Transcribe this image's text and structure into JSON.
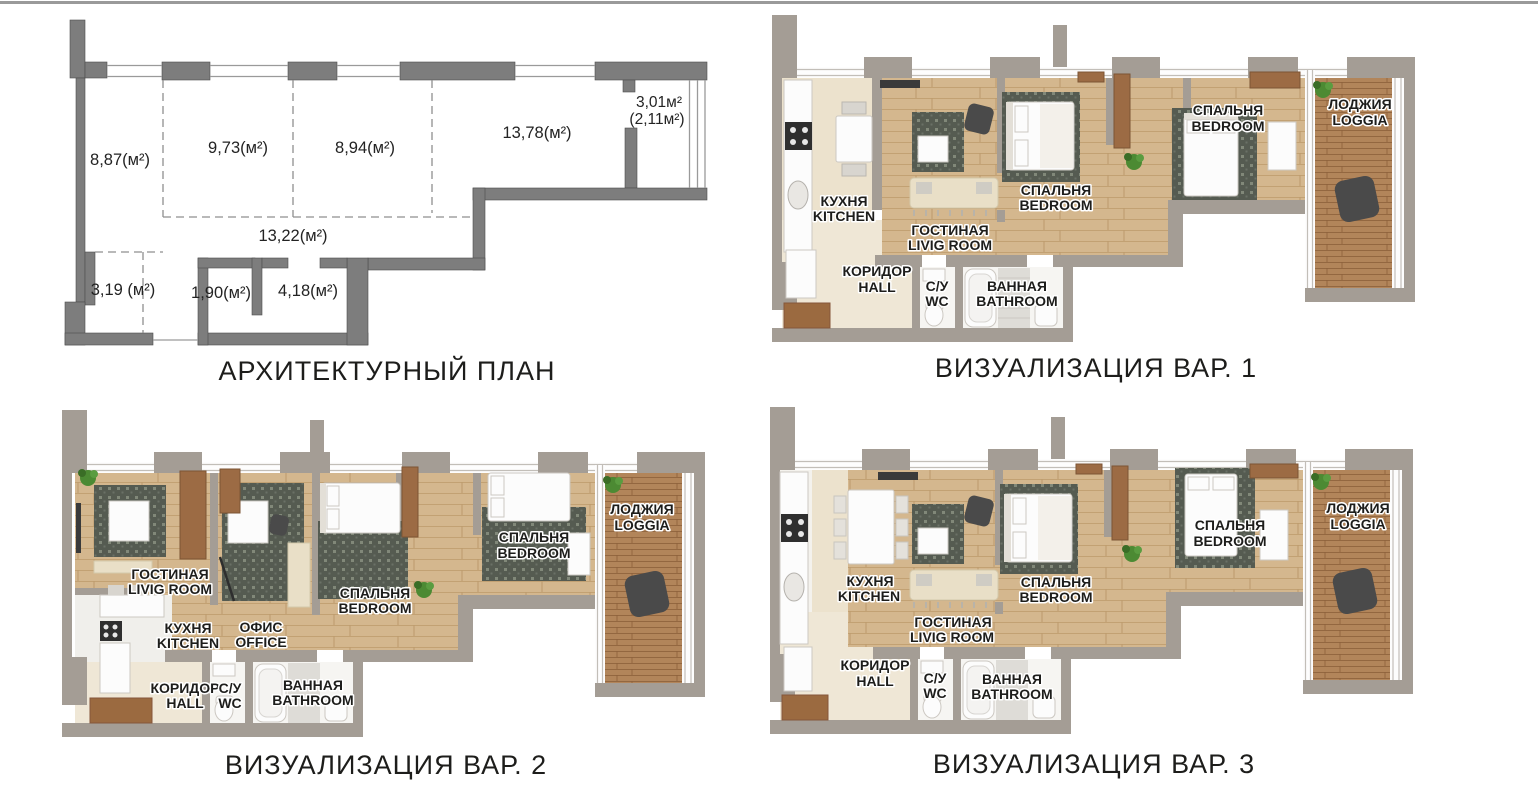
{
  "page": {
    "background": "#ffffff",
    "top_rule_color": "#9a9a9a"
  },
  "palette": {
    "plan_wall": "#7d7d7d",
    "viz_wall": "#a49d95",
    "wood_floor": "#d4b78e",
    "loggia_wood": "#b2855a",
    "kitchen_tile": "#ece2cd",
    "bath_tile": "#f6f5f2",
    "rug_dark": "#555b51",
    "furniture_brown": "#9c6b44",
    "plant_green": "#4c8a33",
    "label_text": "#1d1d1b"
  },
  "plan": {
    "caption": "АРХИТЕКТУРНЫЙ ПЛАН",
    "areas": {
      "room1": "8,87(м²)",
      "room2": "9,73(м²)",
      "room3": "8,94(м²)",
      "room4": "13,78(м²)",
      "balcony1": "3,01м²",
      "balcony2": "(2,11м²)",
      "corridor": "13,22(м²)",
      "room5": "3,19 (м²)",
      "wc": "1,90(м²)",
      "bath": "4,18(м²)"
    }
  },
  "viz1": {
    "caption": "ВИЗУАЛИЗАЦИЯ ВАР. 1",
    "rooms": {
      "kitchen_ru": "КУХНЯ",
      "kitchen_en": "KITCHEN",
      "living_ru": "ГОСТИНАЯ",
      "living_en": "LIVIG ROOM",
      "bedroom1_ru": "СПАЛЬНЯ",
      "bedroom1_en": "BEDROOM",
      "bedroom2_ru": "СПАЛЬНЯ",
      "bedroom2_en": "BEDROOM",
      "loggia_ru": "ЛОДЖИЯ",
      "loggia_en": "LOGGIA",
      "hall_ru": "КОРИДОР",
      "hall_en": "HALL",
      "wc_ru": "С/У",
      "wc_en": "WC",
      "bath_ru": "ВАННАЯ",
      "bath_en": "BATHROOM"
    }
  },
  "viz2": {
    "caption": "ВИЗУАЛИЗАЦИЯ ВАР. 2",
    "rooms": {
      "living_ru": "ГОСТИНАЯ",
      "living_en": "LIVIG ROOM",
      "kitchen_ru": "КУХНЯ",
      "kitchen_en": "KITCHEN",
      "office_ru": "ОФИС",
      "office_en": "OFFICE",
      "bedroom1_ru": "СПАЛЬНЯ",
      "bedroom1_en": "BEDROOM",
      "bedroom2_ru": "СПАЛЬНЯ",
      "bedroom2_en": "BEDROOM",
      "loggia_ru": "ЛОДЖИЯ",
      "loggia_en": "LOGGIA",
      "hall_ru": "КОРИДОР",
      "hall_en": "HALL",
      "wc_ru": "С/У",
      "wc_en": "WC",
      "bath_ru": "ВАННАЯ",
      "bath_en": "BATHROOM"
    }
  },
  "viz3": {
    "caption": "ВИЗУАЛИЗАЦИЯ ВАР. 3",
    "rooms": {
      "kitchen_ru": "КУХНЯ",
      "kitchen_en": "KITCHEN",
      "living_ru": "ГОСТИНАЯ",
      "living_en": "LIVIG ROOM",
      "bedroom1_ru": "СПАЛЬНЯ",
      "bedroom1_en": "BEDROOM",
      "bedroom2_ru": "СПАЛЬНЯ",
      "bedroom2_en": "BEDROOM",
      "loggia_ru": "ЛОДЖИЯ",
      "loggia_en": "LOGGIA",
      "hall_ru": "КОРИДОР",
      "hall_en": "HALL",
      "wc_ru": "С/У",
      "wc_en": "WC",
      "bath_ru": "ВАННАЯ",
      "bath_en": "BATHROOM"
    }
  }
}
